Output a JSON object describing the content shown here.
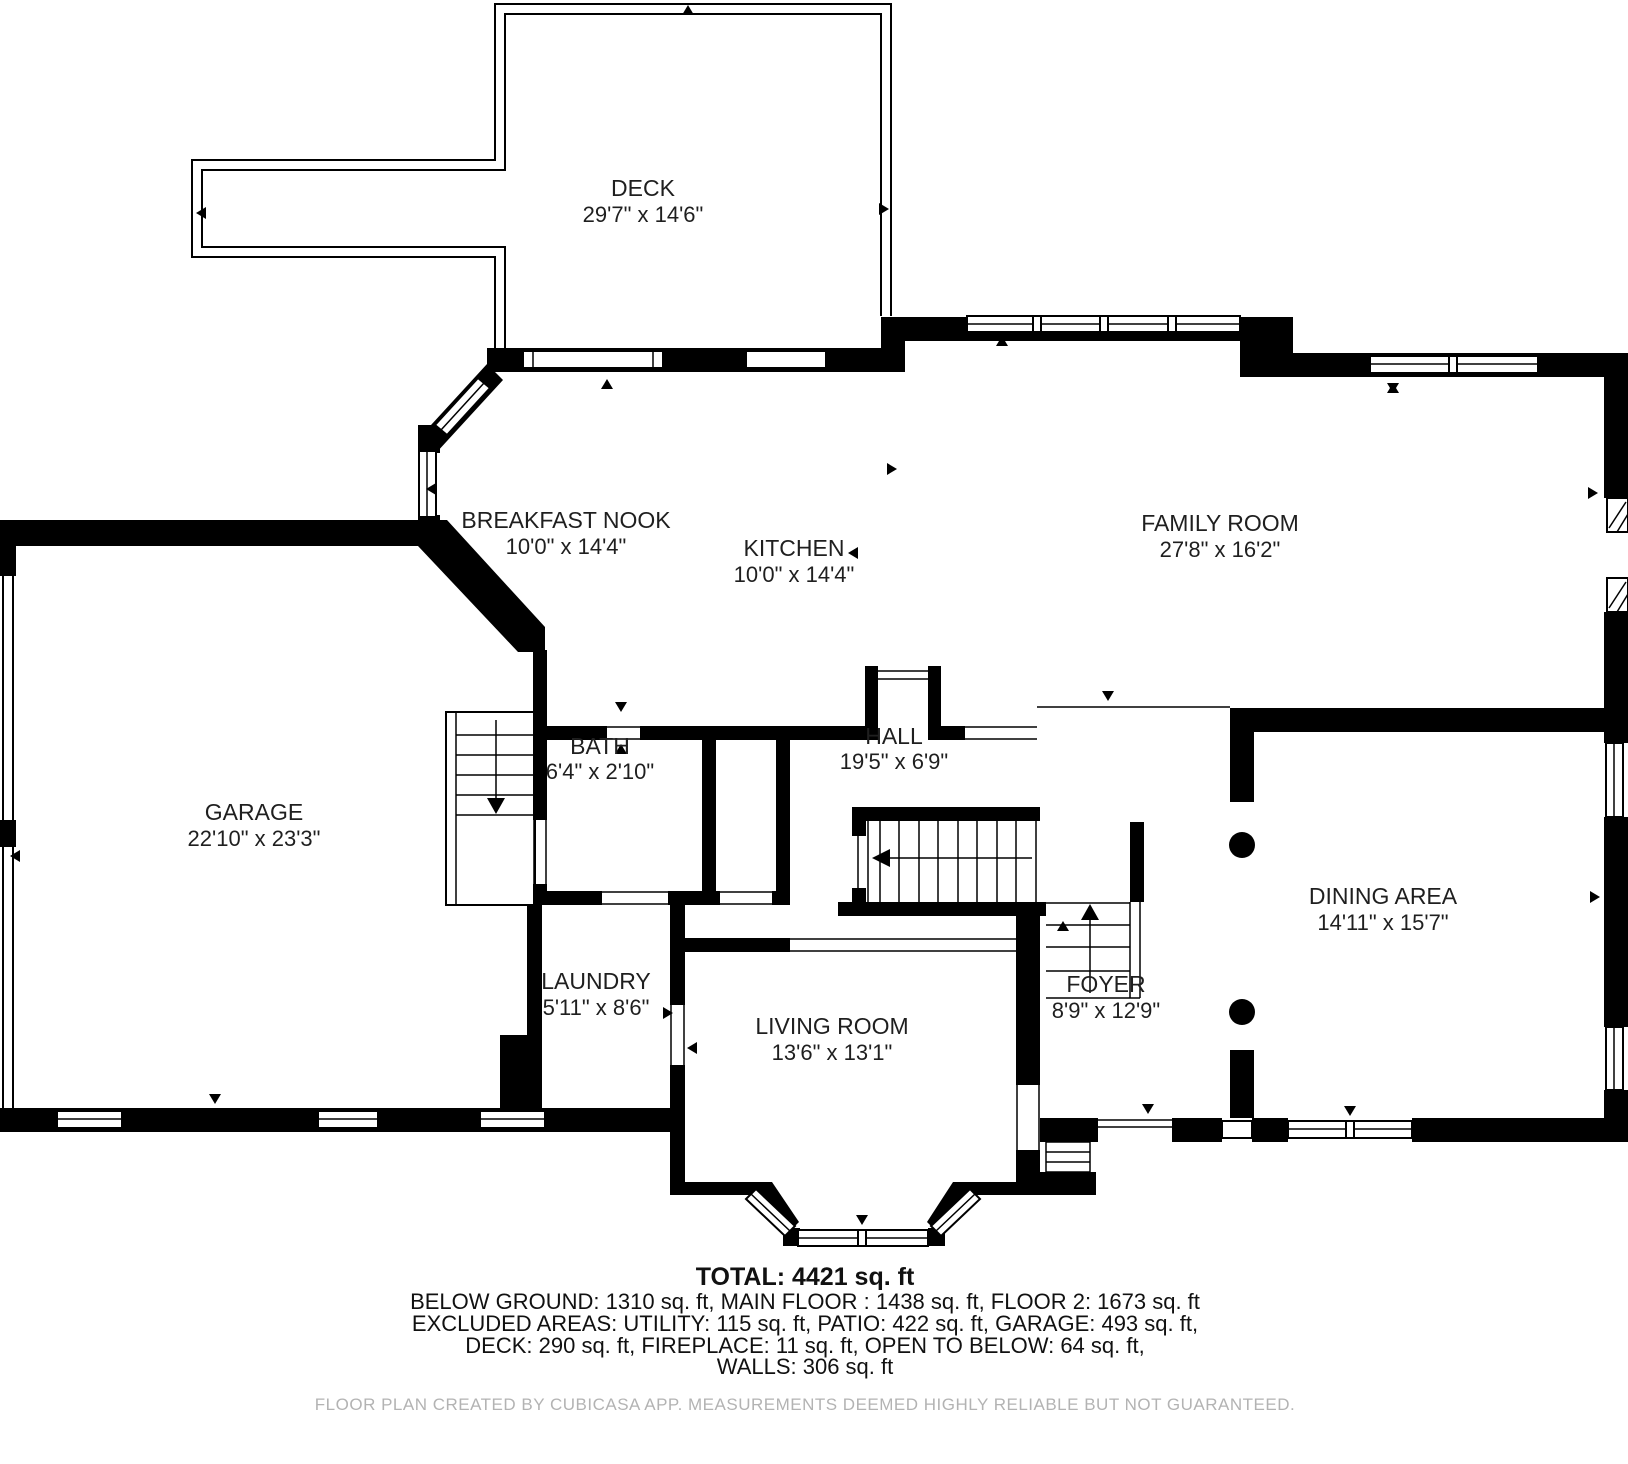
{
  "floor_plan": {
    "rooms": [
      {
        "name": "DECK",
        "dims": "29'7\" x 14'6\""
      },
      {
        "name": "BREAKFAST NOOK",
        "dims": "10'0\" x 14'4\""
      },
      {
        "name": "KITCHEN",
        "dims": "10'0\" x 14'4\""
      },
      {
        "name": "FAMILY ROOM",
        "dims": "27'8\" x 16'2\""
      },
      {
        "name": "GARAGE",
        "dims": "22'10\" x 23'3\""
      },
      {
        "name": "BATH",
        "dims": "6'4\" x 2'10\""
      },
      {
        "name": "HALL",
        "dims": "19'5\" x 6'9\""
      },
      {
        "name": "DINING AREA",
        "dims": "14'11\" x 15'7\""
      },
      {
        "name": "LAUNDRY",
        "dims": "5'11\" x 8'6\""
      },
      {
        "name": "LIVING ROOM",
        "dims": "13'6\" x 13'1\""
      },
      {
        "name": "FOYER",
        "dims": "8'9\" x 12'9\""
      }
    ],
    "summary": {
      "total": "TOTAL: 4421 sq. ft",
      "line1": "BELOW GROUND: 1310 sq. ft, MAIN FLOOR : 1438 sq. ft, FLOOR 2: 1673 sq. ft",
      "line2": "EXCLUDED AREAS: UTILITY: 115 sq. ft, PATIO: 422 sq. ft, GARAGE: 493 sq. ft,",
      "line3": "DECK: 290 sq. ft, FIREPLACE: 11 sq. ft, OPEN TO BELOW: 64 sq. ft,",
      "line4": "WALLS: 306 sq. ft"
    },
    "disclaimer": "FLOOR PLAN CREATED BY CUBICASA APP. MEASUREMENTS DEEMED HIGHLY RELIABLE BUT NOT GUARANTEED.",
    "colors": {
      "wall": "#000000",
      "text": "#1f1f1f",
      "disclaimer": "#b3b3b3"
    }
  }
}
